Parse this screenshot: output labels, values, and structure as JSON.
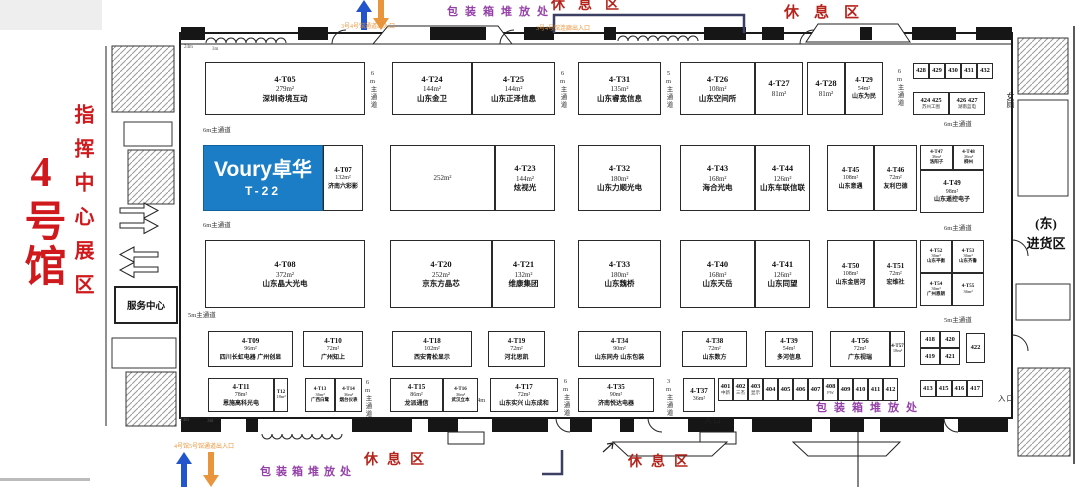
{
  "hall": {
    "title": "4号馆",
    "zone": "指挥中心展区",
    "service_center": "服务中心",
    "east_line1": "(东)",
    "east_line2": "进货区",
    "restroom": "女厕"
  },
  "featured_booth": {
    "brand_latin": "Voury",
    "brand_cjk": "卓华",
    "code": "T-22",
    "color": "#1a7dc5"
  },
  "booths": [
    {
      "code": "4-T05",
      "area": "279m²",
      "name": "深圳奇境互动",
      "x": 205,
      "y": 62,
      "w": 160,
      "h": 53
    },
    {
      "code": "4-T24",
      "area": "144m²",
      "name": "山东金卫",
      "x": 392,
      "y": 62,
      "w": 80,
      "h": 53
    },
    {
      "code": "4-T25",
      "area": "144m²",
      "name": "山东正泽信息",
      "x": 472,
      "y": 62,
      "w": 83,
      "h": 53
    },
    {
      "code": "4-T31",
      "area": "135m²",
      "name": "山东睿宽信息",
      "x": 578,
      "y": 62,
      "w": 83,
      "h": 53
    },
    {
      "code": "4-T26",
      "area": "108m²",
      "name": "山东空间所",
      "x": 680,
      "y": 62,
      "w": 75,
      "h": 53
    },
    {
      "code": "4-T27",
      "area": "81m²",
      "name": "",
      "x": 755,
      "y": 62,
      "w": 48,
      "h": 53
    },
    {
      "code": "4-T28",
      "area": "81m²",
      "name": "",
      "x": 807,
      "y": 62,
      "w": 38,
      "h": 53
    },
    {
      "code": "4-T29",
      "area": "54m²",
      "name": "山东为民",
      "x": 845,
      "y": 62,
      "w": 38,
      "h": 53,
      "cls": "small"
    },
    {
      "code": "4-T07",
      "area": "132m²",
      "name": "济南六彩影",
      "x": 323,
      "y": 145,
      "w": 40,
      "h": 66,
      "cls": "small"
    },
    {
      "code": "",
      "area": "252m²",
      "name": "",
      "x": 390,
      "y": 145,
      "w": 105,
      "h": 66
    },
    {
      "code": "4-T23",
      "area": "144m²",
      "name": "炫视光",
      "x": 495,
      "y": 145,
      "w": 60,
      "h": 66
    },
    {
      "code": "4-T32",
      "area": "180m²",
      "name": "山东力顺光电",
      "x": 578,
      "y": 145,
      "w": 83,
      "h": 66
    },
    {
      "code": "4-T43",
      "area": "168m²",
      "name": "海合光电",
      "x": 680,
      "y": 145,
      "w": 75,
      "h": 66
    },
    {
      "code": "4-T44",
      "area": "126m²",
      "name": "山东车联信联",
      "x": 755,
      "y": 145,
      "w": 55,
      "h": 66
    },
    {
      "code": "4-T45",
      "area": "108m²",
      "name": "山东意遇",
      "x": 827,
      "y": 145,
      "w": 47,
      "h": 66,
      "cls": "small"
    },
    {
      "code": "4-T46",
      "area": "72m²",
      "name": "友利巴德",
      "x": 874,
      "y": 145,
      "w": 43,
      "h": 66,
      "cls": "small"
    },
    {
      "code": "4-T47",
      "area": "36m²",
      "name": "洛阳子",
      "x": 920,
      "y": 145,
      "w": 33,
      "h": 25,
      "cls": "tiny"
    },
    {
      "code": "4-T48",
      "area": "36m²",
      "name": "柳州",
      "x": 953,
      "y": 145,
      "w": 31,
      "h": 25,
      "cls": "tiny"
    },
    {
      "code": "4-T49",
      "area": "98m²",
      "name": "山东遥控电子",
      "x": 920,
      "y": 170,
      "w": 64,
      "h": 43,
      "cls": "small"
    },
    {
      "code": "4-T08",
      "area": "372m²",
      "name": "山东晶大光电",
      "x": 205,
      "y": 240,
      "w": 160,
      "h": 68
    },
    {
      "code": "4-T20",
      "area": "252m²",
      "name": "京东方晶芯",
      "x": 390,
      "y": 240,
      "w": 102,
      "h": 68
    },
    {
      "code": "4-T21",
      "area": "132m²",
      "name": "维康集团",
      "x": 492,
      "y": 240,
      "w": 63,
      "h": 68
    },
    {
      "code": "4-T33",
      "area": "180m²",
      "name": "山东魏桥",
      "x": 578,
      "y": 240,
      "w": 83,
      "h": 68
    },
    {
      "code": "4-T40",
      "area": "168m²",
      "name": "山东天岳",
      "x": 680,
      "y": 240,
      "w": 75,
      "h": 68
    },
    {
      "code": "4-T41",
      "area": "126m²",
      "name": "山东同望",
      "x": 755,
      "y": 240,
      "w": 55,
      "h": 68
    },
    {
      "code": "4-T50",
      "area": "108m²",
      "name": "山东金居河",
      "x": 827,
      "y": 240,
      "w": 47,
      "h": 68,
      "cls": "small"
    },
    {
      "code": "4-T51",
      "area": "72m²",
      "name": "宏维社",
      "x": 874,
      "y": 240,
      "w": 43,
      "h": 68,
      "cls": "small"
    },
    {
      "code": "4-T52",
      "area": "36m²",
      "name": "山东平衡",
      "x": 920,
      "y": 240,
      "w": 32,
      "h": 33,
      "cls": "tiny"
    },
    {
      "code": "4-T53",
      "area": "36m²",
      "name": "山东齐鲁",
      "x": 952,
      "y": 240,
      "w": 32,
      "h": 33,
      "cls": "tiny"
    },
    {
      "code": "4-T54",
      "area": "36m²",
      "name": "广州恩朗",
      "x": 920,
      "y": 273,
      "w": 32,
      "h": 33,
      "cls": "tiny"
    },
    {
      "code": "4-T55",
      "area": "36m²",
      "name": "",
      "x": 952,
      "y": 273,
      "w": 32,
      "h": 33,
      "cls": "tiny"
    },
    {
      "code": "4-T09",
      "area": "96m²",
      "name": "四川长虹电器 广州创显",
      "x": 208,
      "y": 331,
      "w": 85,
      "h": 36,
      "cls": "small"
    },
    {
      "code": "4-T10",
      "area": "72m²",
      "name": "广州知上",
      "x": 303,
      "y": 331,
      "w": 60,
      "h": 36,
      "cls": "small"
    },
    {
      "code": "4-T18",
      "area": "102m²",
      "name": "西安青松显示",
      "x": 392,
      "y": 331,
      "w": 80,
      "h": 36,
      "cls": "small"
    },
    {
      "code": "4-T19",
      "area": "72m²",
      "name": "河北思凯",
      "x": 488,
      "y": 331,
      "w": 57,
      "h": 36,
      "cls": "small"
    },
    {
      "code": "4-T34",
      "area": "90m²",
      "name": "山东同舟 山东包装",
      "x": 578,
      "y": 331,
      "w": 83,
      "h": 36,
      "cls": "small"
    },
    {
      "code": "4-T38",
      "area": "72m²",
      "name": "山东数方",
      "x": 682,
      "y": 331,
      "w": 65,
      "h": 36,
      "cls": "small"
    },
    {
      "code": "4-T39",
      "area": "54m²",
      "name": "多河信息",
      "x": 765,
      "y": 331,
      "w": 48,
      "h": 36,
      "cls": "small"
    },
    {
      "code": "4-T56",
      "area": "72m²",
      "name": "广东视瑞",
      "x": 830,
      "y": 331,
      "w": 60,
      "h": 36,
      "cls": "small"
    },
    {
      "code": "4-T57",
      "area": "18m²",
      "name": "",
      "x": 890,
      "y": 331,
      "w": 15,
      "h": 36,
      "cls": "tiny"
    },
    {
      "code": "4-T11",
      "area": "78m²",
      "name": "恩施高科光电",
      "x": 208,
      "y": 378,
      "w": 66,
      "h": 34,
      "cls": "small"
    },
    {
      "code": "T12",
      "area": "18m²",
      "name": "",
      "x": 274,
      "y": 378,
      "w": 14,
      "h": 34,
      "cls": "tiny"
    },
    {
      "code": "4-T13",
      "area": "36m²",
      "name": "广西白鹭",
      "x": 305,
      "y": 378,
      "w": 30,
      "h": 34,
      "cls": "tiny"
    },
    {
      "code": "4-T14",
      "area": "36m²",
      "name": "烟台仪表",
      "x": 335,
      "y": 378,
      "w": 27,
      "h": 34,
      "cls": "tiny"
    },
    {
      "code": "4-T15",
      "area": "86m²",
      "name": "龙派通信",
      "x": 390,
      "y": 378,
      "w": 53,
      "h": 34,
      "cls": "small"
    },
    {
      "code": "4-T16",
      "area": "36m²",
      "name": "武汉立本",
      "x": 443,
      "y": 378,
      "w": 35,
      "h": 34,
      "cls": "tiny"
    },
    {
      "code": "4-T17",
      "area": "72m²",
      "name": "山东实兴 山东成和",
      "x": 490,
      "y": 378,
      "w": 68,
      "h": 34,
      "cls": "small"
    },
    {
      "code": "4-T35",
      "area": "90m²",
      "name": "济南悦达电器",
      "x": 578,
      "y": 378,
      "w": 76,
      "h": 34,
      "cls": "small"
    },
    {
      "code": "4-T37",
      "area": "36m²",
      "name": "",
      "x": 683,
      "y": 378,
      "w": 32,
      "h": 34,
      "cls": "small"
    }
  ],
  "small_booth_clusters": [
    {
      "x": 913,
      "y": 63,
      "w": 80,
      "h": 16,
      "cols": 5,
      "cells": [
        {
          "c": "428"
        },
        {
          "c": "429"
        },
        {
          "c": "430"
        },
        {
          "c": "431"
        },
        {
          "c": "432"
        }
      ]
    },
    {
      "x": 913,
      "y": 92,
      "w": 72,
      "h": 23,
      "cols": 2,
      "cells": [
        {
          "c": "424 425",
          "s": "苏州工图"
        },
        {
          "c": "426 427",
          "s": "湖南蓝电"
        }
      ]
    },
    {
      "x": 920,
      "y": 331,
      "w": 40,
      "h": 34,
      "cols": 2,
      "cells": [
        {
          "c": "418"
        },
        {
          "c": "420"
        },
        {
          "c": "419"
        },
        {
          "c": "421"
        }
      ]
    },
    {
      "x": 966,
      "y": 333,
      "w": 19,
      "h": 30,
      "cols": 1,
      "cells": [
        {
          "c": "422"
        }
      ]
    },
    {
      "x": 718,
      "y": 378,
      "w": 180,
      "h": 23,
      "cols": 12,
      "cells": [
        {
          "c": "401",
          "s": "中新"
        },
        {
          "c": "402",
          "s": "三杰"
        },
        {
          "c": "403",
          "s": "显示"
        },
        {
          "c": "404"
        },
        {
          "c": "405"
        },
        {
          "c": "406"
        },
        {
          "c": "407"
        },
        {
          "c": "408",
          "s": "PW"
        },
        {
          "c": "409"
        },
        {
          "c": "410"
        },
        {
          "c": "411"
        },
        {
          "c": "412"
        }
      ]
    },
    {
      "x": 920,
      "y": 380,
      "w": 63,
      "h": 17,
      "cols": 4,
      "cells": [
        {
          "c": "413"
        },
        {
          "c": "415"
        },
        {
          "c": "416"
        },
        {
          "c": "417"
        }
      ]
    }
  ],
  "aisle_labels": [
    {
      "t": "6m主通道",
      "x": 367,
      "y": 70,
      "v": 1
    },
    {
      "t": "6m主通道",
      "x": 557,
      "y": 70,
      "v": 1
    },
    {
      "t": "5m主通道",
      "x": 663,
      "y": 70,
      "v": 1
    },
    {
      "t": "6m主通道",
      "x": 894,
      "y": 68,
      "v": 1
    },
    {
      "t": "6m主通道",
      "x": 203,
      "y": 124
    },
    {
      "t": "6m主通道",
      "x": 203,
      "y": 219
    },
    {
      "t": "5m主通道",
      "x": 188,
      "y": 309
    },
    {
      "t": "6m主通道",
      "x": 944,
      "y": 118
    },
    {
      "t": "6m主通道",
      "x": 944,
      "y": 222
    },
    {
      "t": "5m主通道",
      "x": 944,
      "y": 314
    },
    {
      "t": "6m主通道",
      "x": 362,
      "y": 379,
      "v": 1
    },
    {
      "t": "6m主通道",
      "x": 560,
      "y": 378,
      "v": 1
    },
    {
      "t": "3m主通道",
      "x": 663,
      "y": 378,
      "v": 1
    },
    {
      "t": "4m",
      "x": 477,
      "y": 397
    }
  ],
  "dim_labels": [
    {
      "t": "24m",
      "x": 184,
      "y": 45
    },
    {
      "t": "3m",
      "x": 212,
      "y": 47
    },
    {
      "t": "24m",
      "x": 180,
      "y": 418
    },
    {
      "t": "3m",
      "x": 207,
      "y": 419
    }
  ],
  "annotations": [
    {
      "t": "包装箱堆放处",
      "x": 447,
      "y": 3,
      "c": "#9440a8",
      "fs": 11,
      "ls": 7,
      "b": 1,
      "n": "packing-area-label"
    },
    {
      "t": "休息区",
      "x": 551,
      "y": -6,
      "c": "#b5241c",
      "fs": 14,
      "ls": 13,
      "b": 1,
      "n": "rest-area-label"
    },
    {
      "t": "休息区",
      "x": 784,
      "y": 1,
      "c": "#b5241c",
      "fs": 15,
      "ls": 15,
      "b": 1,
      "n": "rest-area-label"
    },
    {
      "t": "3号4号馆通道出入口",
      "x": 341,
      "y": 21,
      "c": "#e8953c",
      "fs": 6,
      "ls": 0,
      "n": "corridor-entrance-label"
    },
    {
      "t": "3号4号馆连廊出入口",
      "x": 536,
      "y": 23,
      "c": "#e8953c",
      "fs": 6,
      "ls": 0,
      "n": "corridor-entrance-label"
    },
    {
      "t": "4号馆5号馆通道出入口",
      "x": 174,
      "y": 441,
      "c": "#e8953c",
      "fs": 6,
      "ls": 0,
      "n": "corridor-entrance-label"
    },
    {
      "t": "休息区",
      "x": 364,
      "y": 449,
      "c": "#b5241c",
      "fs": 14,
      "ls": 9,
      "b": 1,
      "n": "rest-area-label"
    },
    {
      "t": "休息区",
      "x": 628,
      "y": 451,
      "c": "#b5241c",
      "fs": 14,
      "ls": 9,
      "b": 1,
      "n": "rest-area-label"
    },
    {
      "t": "包装箱堆放处",
      "x": 260,
      "y": 463,
      "c": "#9440a8",
      "fs": 11,
      "ls": 5,
      "b": 1,
      "n": "packing-area-label"
    },
    {
      "t": "包装箱堆放处",
      "x": 816,
      "y": 399,
      "c": "#9440a8",
      "fs": 11,
      "ls": 7,
      "b": 1,
      "n": "packing-area-label"
    },
    {
      "t": "入口",
      "x": 704,
      "y": 415,
      "c": "#222",
      "fs": 7.5,
      "ls": 2,
      "n": "entrance-label"
    },
    {
      "t": "入口",
      "x": 998,
      "y": 393,
      "c": "#222",
      "fs": 7.5,
      "ls": 1,
      "n": "entrance-label"
    }
  ]
}
